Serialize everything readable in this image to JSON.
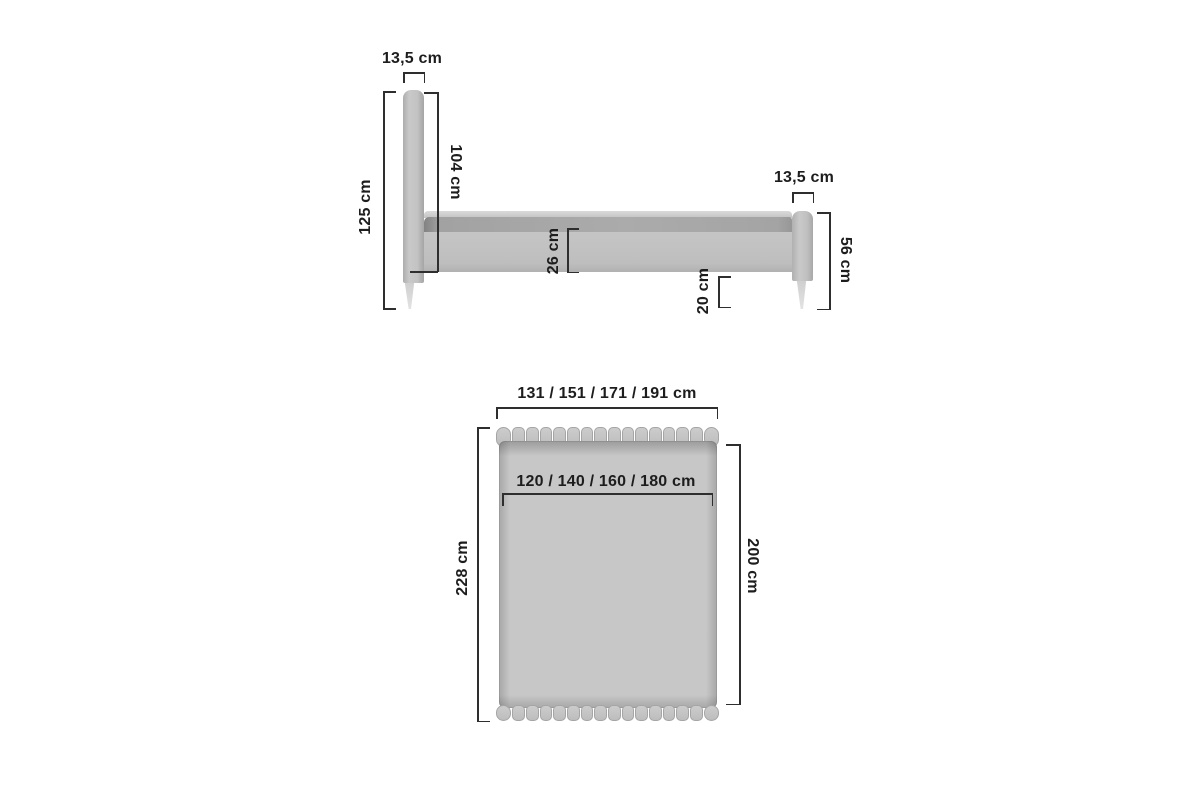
{
  "side_view": {
    "title": "bed-side-view",
    "headboard_width": "13,5 cm",
    "total_height": "125 cm",
    "headboard_panel_height": "104 cm",
    "side_rail_height": "26 cm",
    "under_bed_clearance": "20 cm",
    "footboard_height": "56 cm",
    "footboard_width": "13,5 cm"
  },
  "top_view": {
    "title": "bed-top-view",
    "outer_width_variants": "131 / 151 / 171 / 191 cm",
    "mattress_width_variants": "120 / 140 / 160 / 180 cm",
    "outer_length": "228 cm",
    "mattress_length": "200 cm",
    "headboard_segment_count": 16,
    "footboard_segment_count": 16
  },
  "colors": {
    "background": "#ffffff",
    "furniture_light": "#c6c6c6",
    "mattress_band": "#a6a6a6",
    "dimension_line": "#2e2e2e",
    "label_text": "#1d1d1d"
  }
}
